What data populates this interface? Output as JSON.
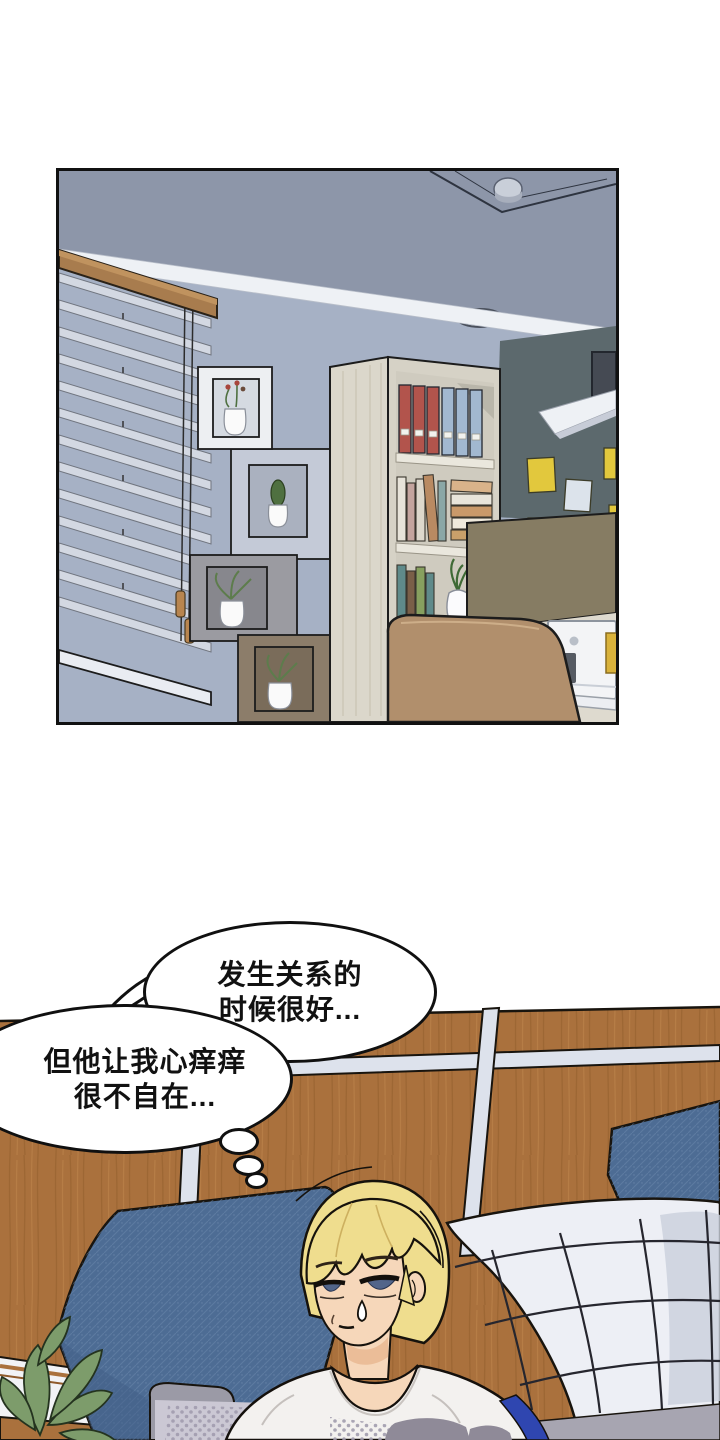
{
  "page": {
    "width": 720,
    "height": 1440,
    "background": "#ffffff"
  },
  "top_panel": {
    "label": "study-room-scene",
    "border_color": "#111111",
    "colors": {
      "ceiling": "#8d96a9",
      "wall": "#a6b1c5",
      "accent_wall": "#5c696d",
      "molding": "#eef1f5",
      "blinds_slat": "#d3d8e2",
      "valance_wood": "#a87c4e",
      "bookshelf_wood": "#d6d2c6",
      "binder_red": "#b2544c",
      "binder_blue": "#a2b8d0",
      "sticky_yellow": "#e2c83d",
      "sticky_white": "#dce3eb",
      "divider": "#867c63",
      "chair": "#b18f6c",
      "imac": "#f3f4f6"
    }
  },
  "bubbles": {
    "bubble1": {
      "line1": "发生关系的",
      "line2": "时候很好..."
    },
    "bubble2": {
      "line1": "但他让我心痒痒",
      "line2": "很不自在..."
    }
  },
  "bottom_scene": {
    "label": "sofa-scene",
    "colors": {
      "wood_wall": "#aa713d",
      "grout": "#dde2ec",
      "denim_pillow": "#4d6c94",
      "quilt_pillow": "#edeff5",
      "sofa": "#9b9aa6",
      "table": "#cbc8d4",
      "plant": "#7d9c6b",
      "hair": "#efdd8e",
      "skin": "#f6d7ba",
      "shirt": "#f3f1ef",
      "stripe_blue": "#2f46b0"
    }
  }
}
